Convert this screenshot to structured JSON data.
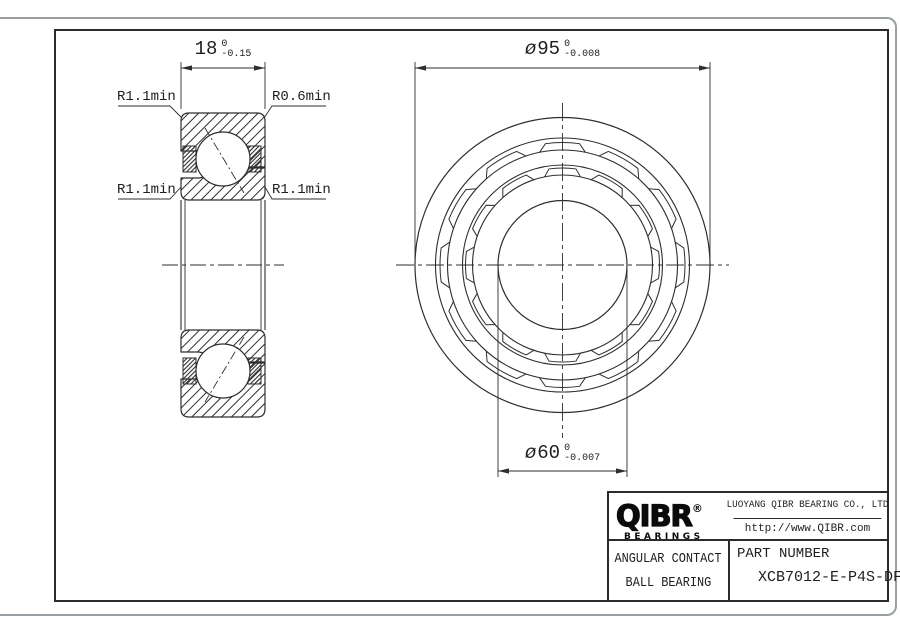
{
  "drawing": {
    "section_view": {
      "width_dim": {
        "value": "18",
        "tol_upper": "0",
        "tol_lower": "-0.15"
      },
      "fillet_labels": {
        "top_left": "R1.1min",
        "top_right": "R0.6min",
        "mid_left": "R1.1min",
        "mid_right": "R1.1min"
      }
    },
    "front_view": {
      "outer_diameter_dim": {
        "symbol": "ø",
        "value": "95",
        "tol_upper": "0",
        "tol_lower": "-0.008"
      },
      "bore_diameter_dim": {
        "symbol": "ø",
        "value": "60",
        "tol_upper": "0",
        "tol_lower": "-0.007"
      }
    }
  },
  "title_block": {
    "brand": {
      "name": "QIBR",
      "registered_mark": "®",
      "tagline": "BEARINGS"
    },
    "company_name": "LUOYANG QIBR BEARING CO., LTD",
    "website": "http://www.QIBR.com",
    "product_type_line1": "ANGULAR CONTACT",
    "product_type_line2": "BALL BEARING",
    "part_number_label": "PART NUMBER",
    "part_number": "XCB7012-E-P4S-DF"
  },
  "colors": {
    "line": "#2e2e2e",
    "text": "#1e1e1e",
    "window_border": "#9aa0a3"
  }
}
